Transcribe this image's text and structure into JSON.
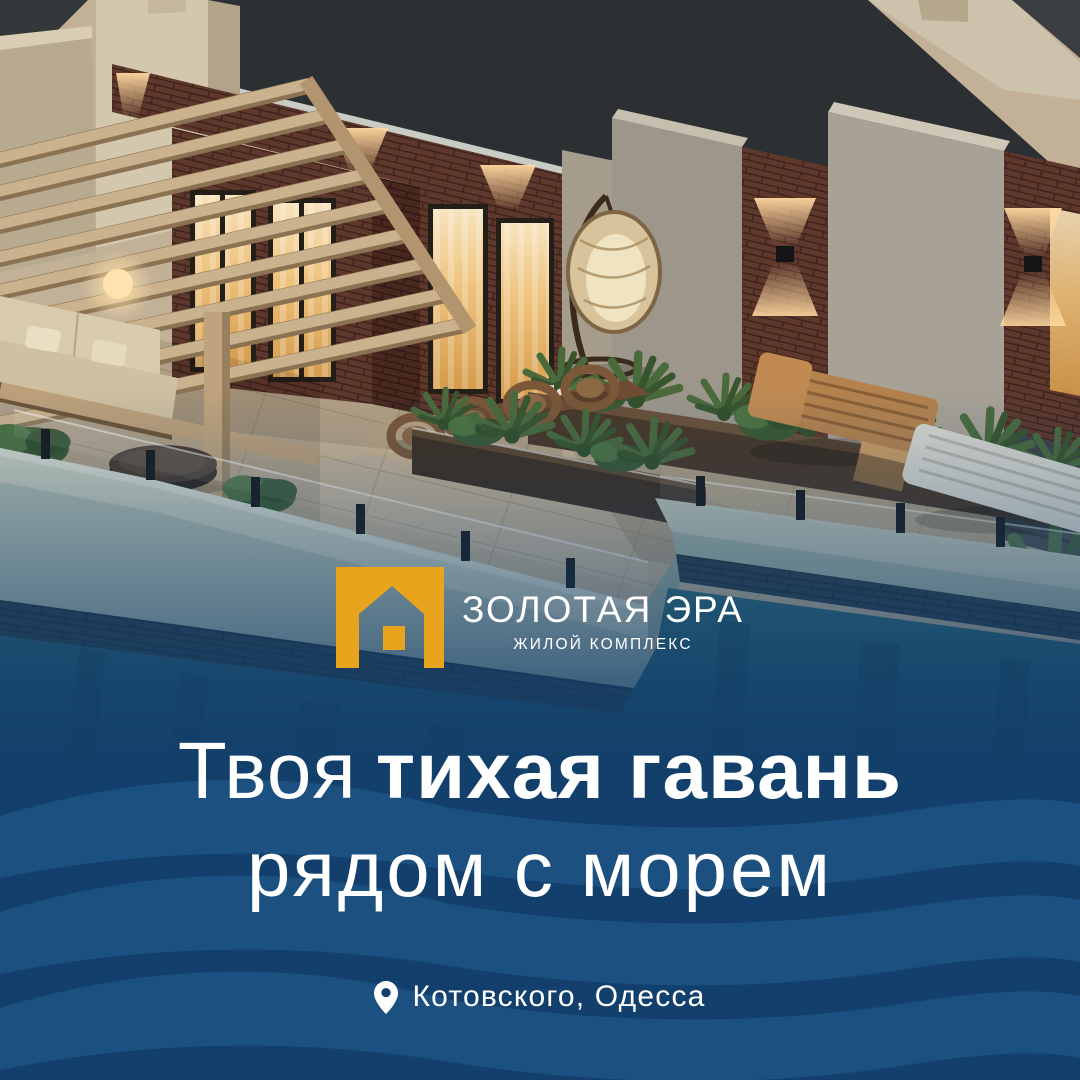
{
  "poster": {
    "brand": {
      "name": "ЗОЛОТАЯ ЭРА",
      "tagline": "ЖИЛОЙ КОМПЛЕКС"
    },
    "headline": {
      "line1_regular": "Твоя",
      "line1_bold": "тихая гавань",
      "line2": "рядом с морем"
    },
    "location": {
      "label": "Котовского, Одесса"
    },
    "colors": {
      "brand_gold": "#E9A41E",
      "deep_blue": "#123F6B",
      "wave_blue": "#1B5080",
      "text": "#FFFFFF"
    },
    "icons": {
      "logo": "house-icon",
      "location": "map-pin-icon",
      "background_motif": "wave-pattern"
    }
  }
}
